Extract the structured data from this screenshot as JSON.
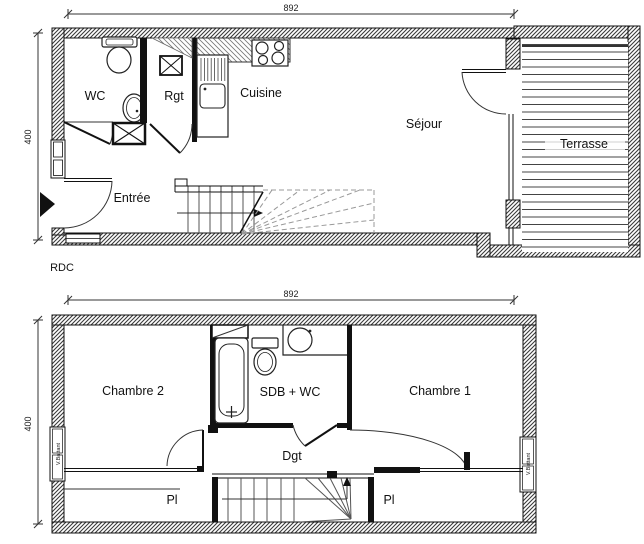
{
  "rdc": {
    "floor_label": "RDC",
    "dim_width": "892",
    "dim_height": "400",
    "rooms": {
      "wc": "WC",
      "rgt": "Rgt",
      "cuisine": "Cuisine",
      "sejour": "Séjour",
      "entree": "Entrée",
      "terrasse": "Terrasse"
    }
  },
  "etage": {
    "dim_width": "892",
    "dim_height": "400",
    "rooms": {
      "chambre2": "Chambre 2",
      "sdb": "SDB + WC",
      "chambre1": "Chambre 1",
      "dgt": "Dgt",
      "pl_left": "Pl",
      "pl_right": "Pl"
    },
    "windows": {
      "left": "V.Battant",
      "right": "V.Battant"
    }
  },
  "colors": {
    "line": "#111111",
    "hatch": "#3a3a3a",
    "background": "#ffffff"
  }
}
